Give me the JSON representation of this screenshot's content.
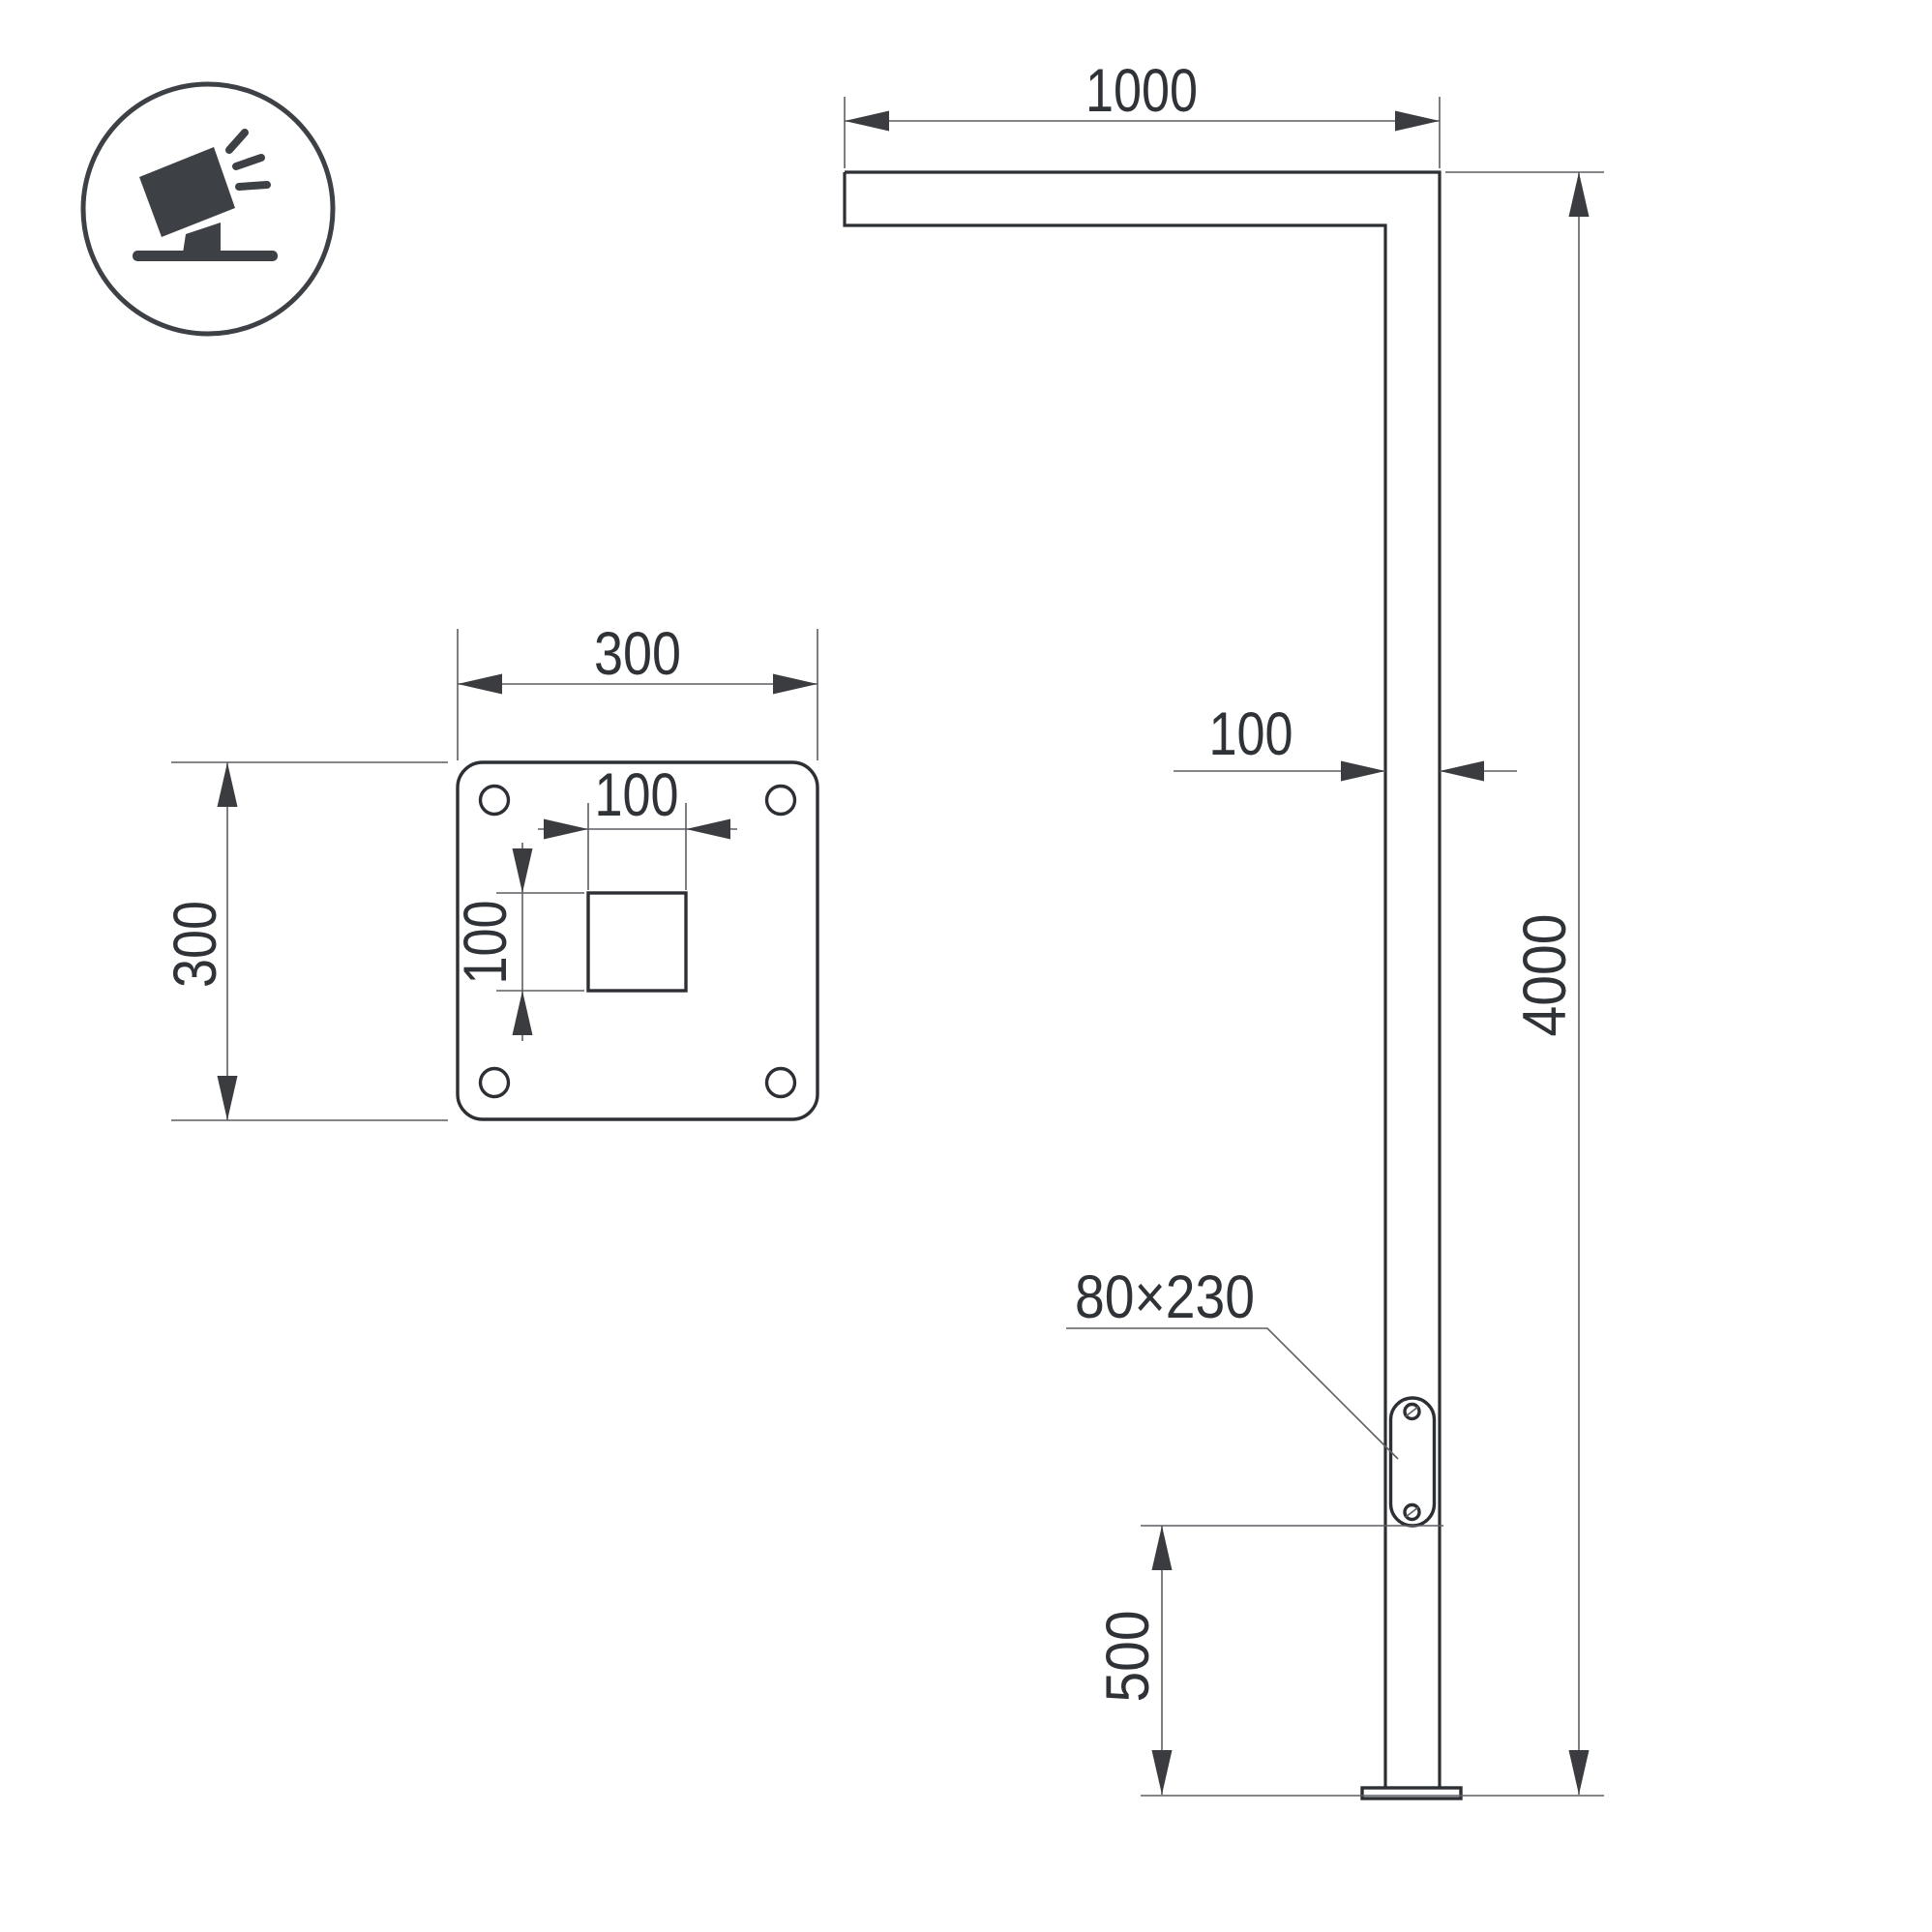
{
  "title": "Street light pole dimensional drawing",
  "colors": {
    "background": "#ffffff",
    "outline": "#2c2f33",
    "dimension_line": "#5d5f63",
    "arrow": "#3a3c40",
    "text": "#2f3236",
    "icon": "#3d4044"
  },
  "icon": {
    "name": "tilted-floodlight-on-stand"
  },
  "side_view": {
    "arm_length": "1000",
    "pole_width": "100",
    "total_height": "4000",
    "hand_hole_size": "80×230",
    "hand_hole_elevation": "500"
  },
  "plate_view": {
    "plate_width": "300",
    "plate_height": "300",
    "cutout_width": "100",
    "cutout_height": "100"
  }
}
